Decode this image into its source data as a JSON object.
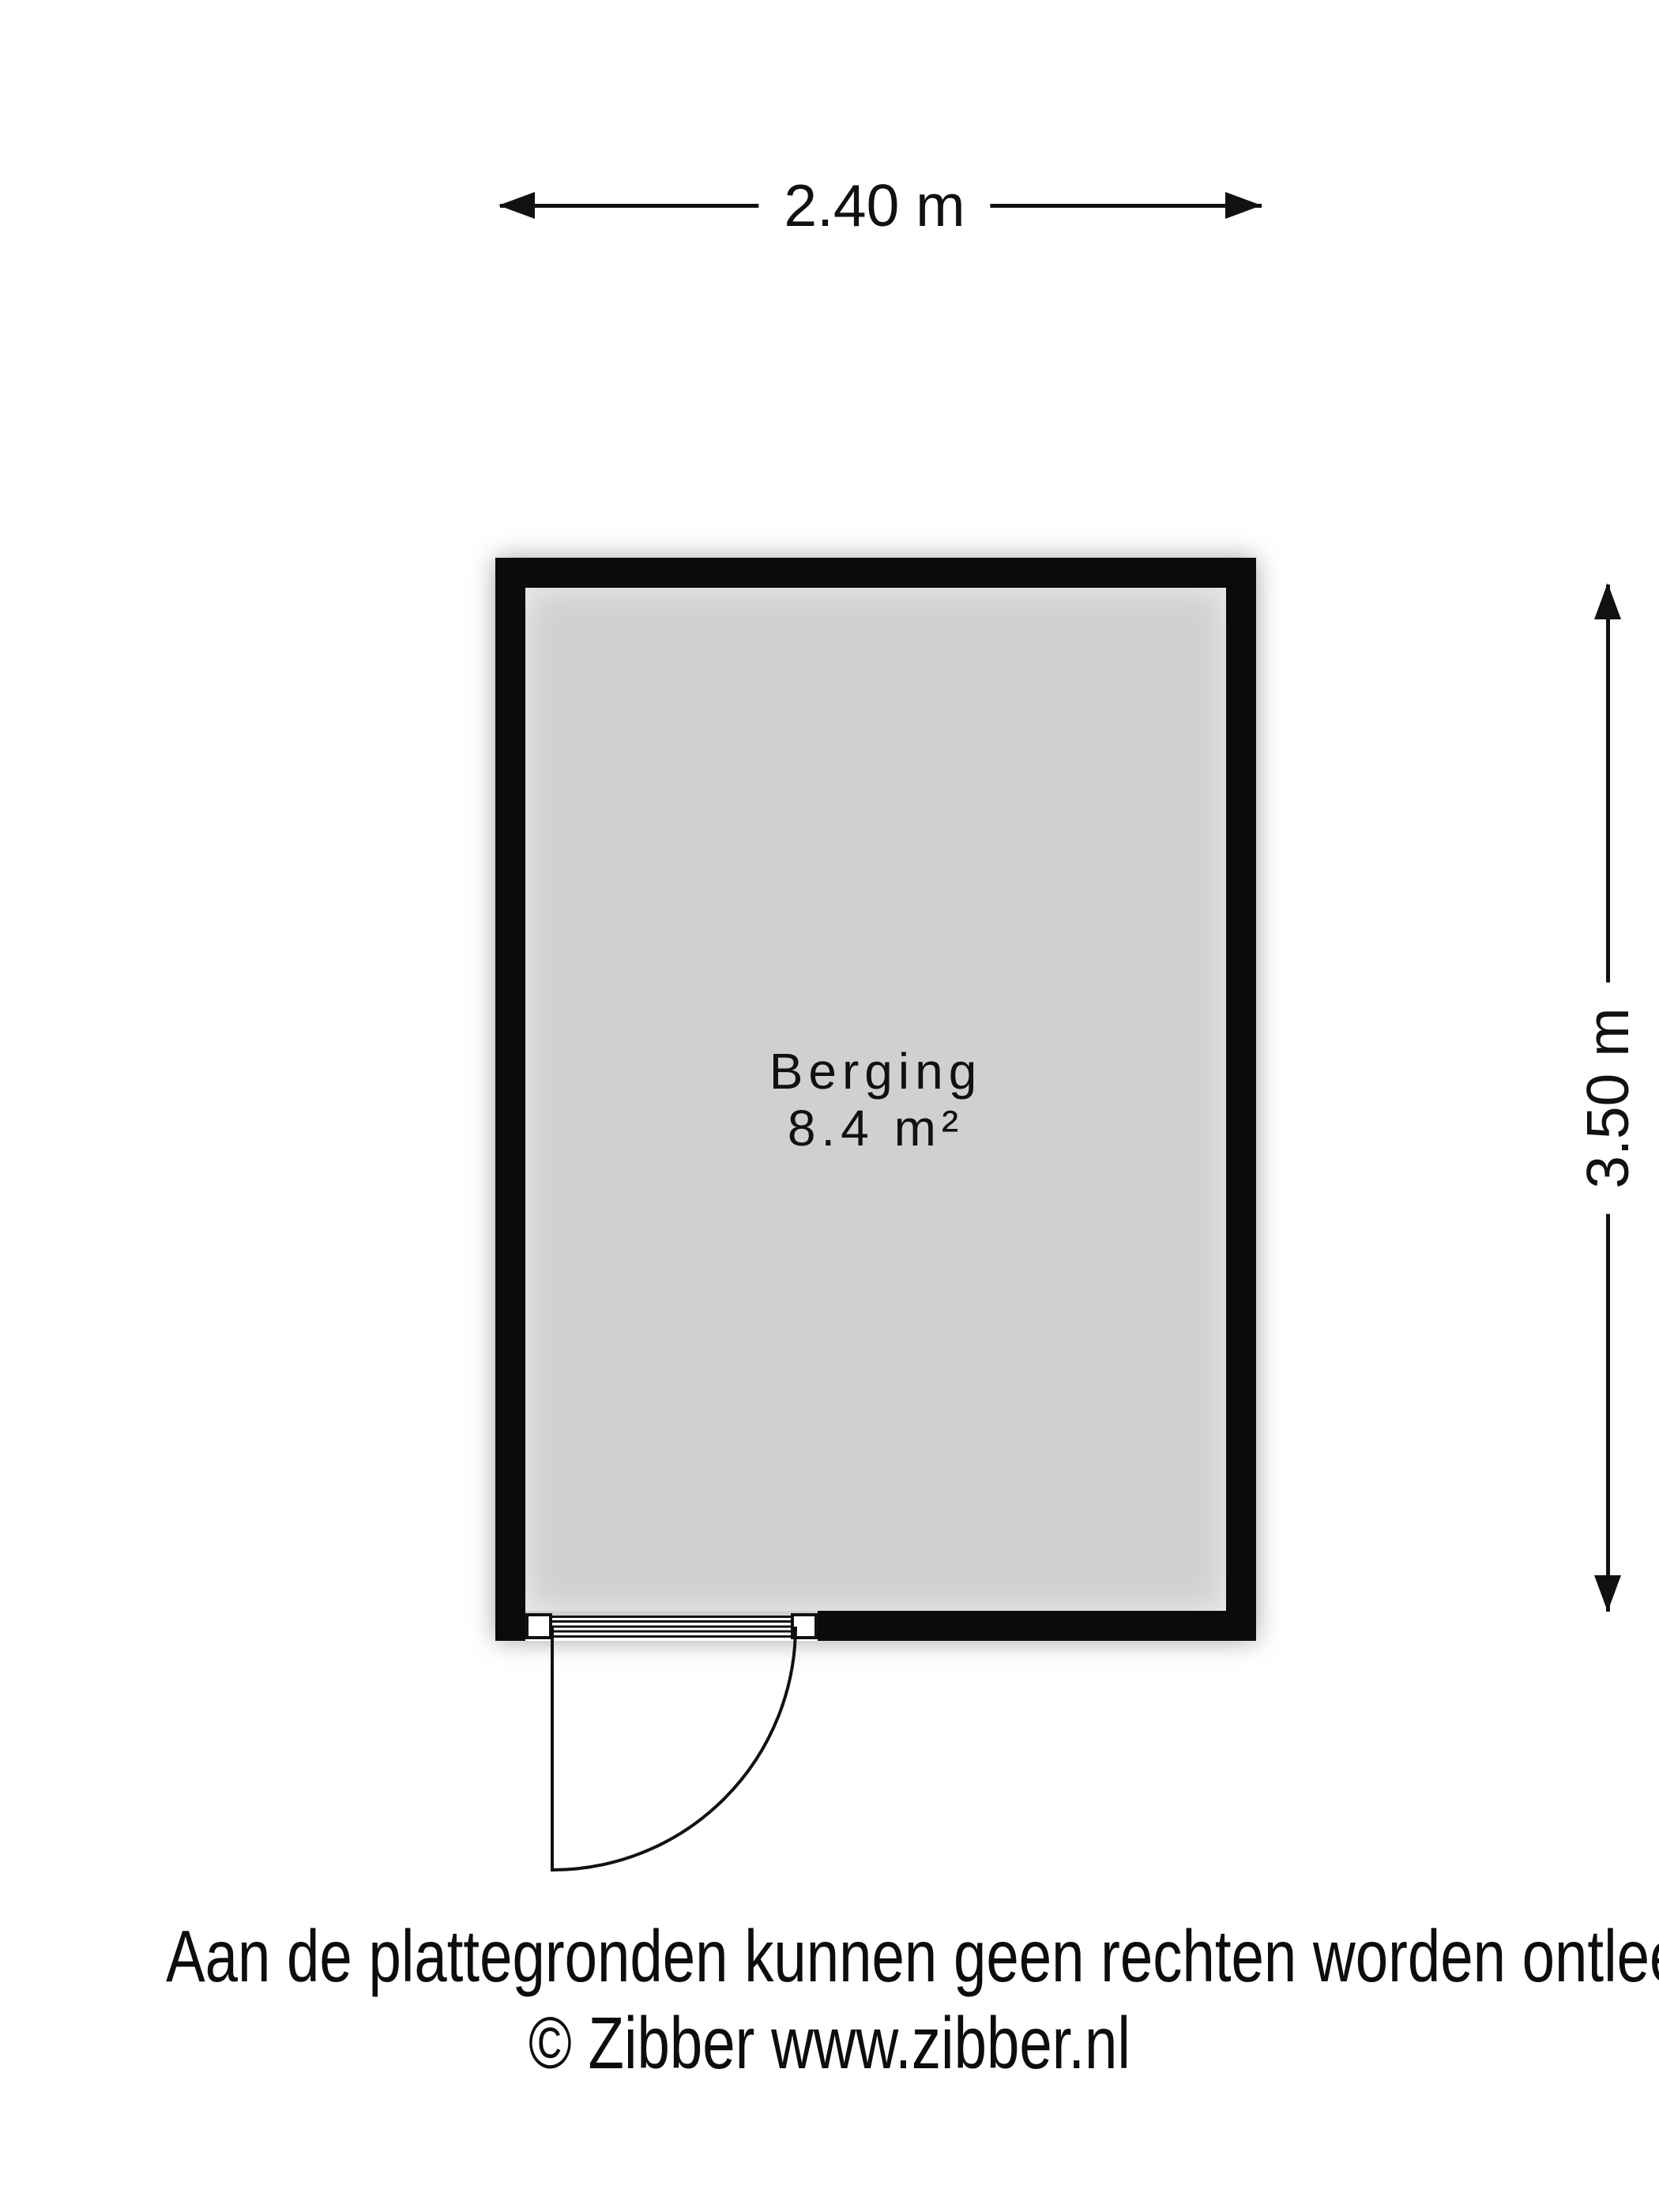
{
  "colors": {
    "background": "#ffffff",
    "wall": "#0b0b0b",
    "floor": "#d0d0d0",
    "line": "#111111"
  },
  "dimensions": {
    "width_label": "2.40 m",
    "height_label": "3.50 m"
  },
  "room": {
    "name": "Berging",
    "area": "8.4 m²"
  },
  "footer": {
    "disclaimer": "Aan de plattegronden kunnen geen rechten worden ontleend",
    "copyright": "© Zibber www.zibber.nl"
  }
}
